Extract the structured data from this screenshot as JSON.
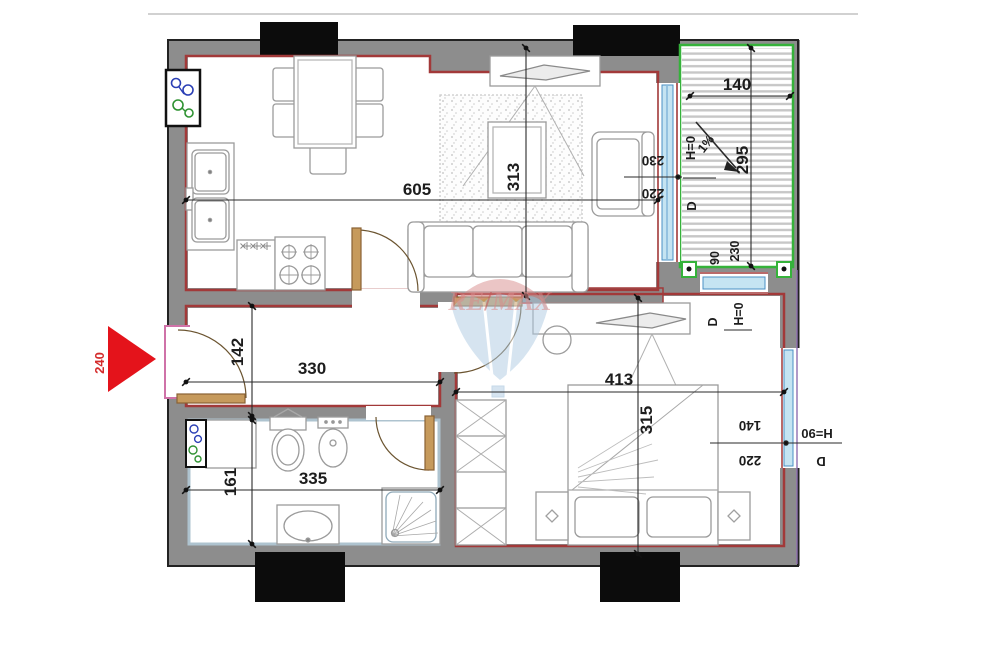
{
  "watermark": {
    "re": "RE",
    "slash": "/",
    "max": "MAX"
  },
  "entrance": {
    "label": "240"
  },
  "dims": {
    "living_width": "605",
    "living_depth": "313",
    "balcony_width": "140",
    "balcony_depth": "295",
    "balcony_slope": "1%",
    "balcony_lower_depth": "90",
    "balcony_lower_width": "230",
    "hall_width": "330",
    "hall_depth": "142",
    "bath_width": "335",
    "bath_depth": "161",
    "bedroom_width": "413",
    "bedroom_depth": "315"
  },
  "openings": {
    "balcony_door": {
      "w": "220",
      "h": "230",
      "tag": "D",
      "threshold": "H=0"
    },
    "bedroom_balcony_door": {
      "tag": "D",
      "threshold": "H=0"
    },
    "bedroom_window": {
      "w": "220",
      "h": "140",
      "parapet": "H=90",
      "tag": "D"
    }
  },
  "icons": {
    "utility_meter_top": "utility-meter-icon",
    "utility_meter_bath": "utility-meter-icon",
    "entrance_arrow": "entrance-arrow-icon"
  },
  "colors": {
    "wall_fill": "#8d8d8d",
    "wall_lining_red": "#a23939",
    "balcony_green": "#35b23a",
    "window_blue": "#c5e4f2",
    "bath_lining": "#aec3cf",
    "entrance_arrow_red": "#e4131b",
    "door_tan": "#c69a5c",
    "watermark_blue": "#aecbe2",
    "watermark_red": "#d98c8c",
    "facade_purple": "#9070b0"
  }
}
